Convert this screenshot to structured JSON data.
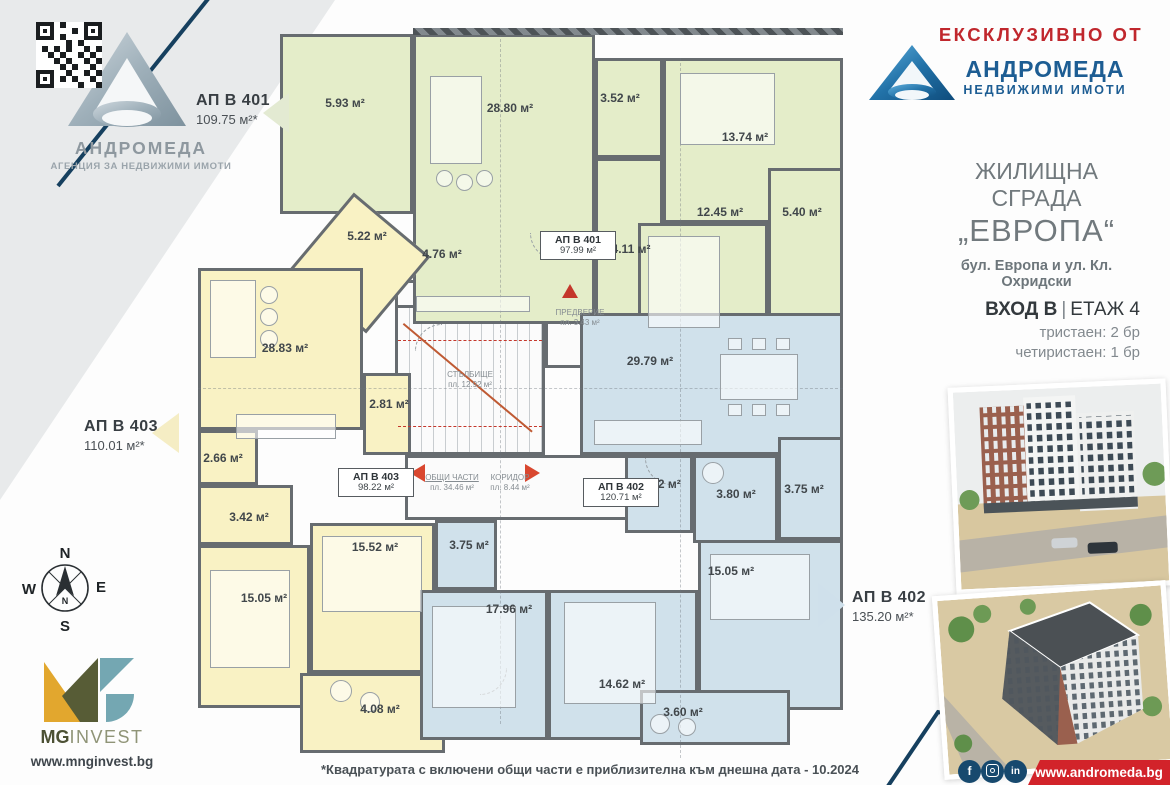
{
  "brand_left": {
    "name": "АНДРОМЕДА",
    "tagline": "АГЕНЦИЯ ЗА НЕДВИЖИМИ ИМОТИ"
  },
  "brand_right": {
    "kicker": "ЕКСКЛУЗИВНО ОТ",
    "name": "АНДРОМЕДА",
    "tagline": "НЕДВИЖИМИ ИМОТИ"
  },
  "project": {
    "type": "ЖИЛИЩНА СГРАДА",
    "name": "„ЕВРОПА“",
    "address": "бул. Европа и ул. Кл. Охридски",
    "entrance": "ВХОД В",
    "floor": "ЕТАЖ 4",
    "mix": [
      "тристаен: 2 бр",
      "четиристаен: 1 бр"
    ]
  },
  "apartments": {
    "a401": {
      "name": "АП В 401",
      "total": "109.75 м²*",
      "net": "97.99 м²"
    },
    "a402": {
      "name": "АП В 402",
      "total": "135.20 м²*",
      "net": "120.71 м²"
    },
    "a403": {
      "name": "АП В 403",
      "total": "110.01 м²*",
      "net": "98.22 м²"
    }
  },
  "rooms": {
    "g_terrace1": "5.93 м²",
    "g_living": "28.80 м²",
    "g_bath": "3.52 м²",
    "g_bed1": "13.74 м²",
    "g_bed2": "12.45 м²",
    "g_terrace2": "5.40 м²",
    "g_hall1": "4.11 м²",
    "g_hall2": "4.76 м²",
    "y_room1": "5.22 м²",
    "y_living": "28.83 м²",
    "y_hall": "2.81 м²",
    "y_wc": "2.66 м²",
    "y_bath": "3.42 м²",
    "y_bed1": "15.52 м²",
    "y_bed2": "15.05 м²",
    "y_terrace": "4.08 м²",
    "b_living": "29.79 м²",
    "b_wc": "1.92 м²",
    "b_bath": "3.80 м²",
    "b_terrace1": "3.75 м²",
    "b_store": "3.75 м²",
    "b_bed1": "17.96 м²",
    "b_bed2": "14.62 м²",
    "b_bed3": "15.05 м²",
    "b_terrace2": "3.60 м²"
  },
  "common": {
    "stairs": "СТЪЛБИЩЕ",
    "stairs_area": "пл. 12.92 м²",
    "vestibule": "ПРЕДВЕРИЕ",
    "vestibule_area": "пл. 3.43 м²",
    "shared": "ОБЩИ ЧАСТИ",
    "shared_area": "пл. 34.46 м²",
    "corridor": "КОРИДОР",
    "corridor_area": "пл. 8.44 м²"
  },
  "compass": {
    "n": "N",
    "e": "E",
    "s": "S",
    "w": "W",
    "needle": "N"
  },
  "developer": {
    "mg": "MG",
    "invest": "INVEST",
    "website": "www.mnginvest.bg"
  },
  "footer": {
    "note": "*Квадратурата с включени общи части е приблизителна към днешна дата - 10.2024",
    "website": "www.andromeda.bg"
  },
  "social": {
    "facebook": "f",
    "linkedin": "in"
  },
  "colors": {
    "apartment_green": "#e4edc9",
    "apartment_yellow": "#f9f2c4",
    "apartment_blue": "#d0e1eb",
    "accent_red": "#c0272d",
    "plan_arrow_red": "#d9472f",
    "navy": "#16405f",
    "brand_blue": "#1d5d93",
    "mg_yellow": "#e2a72e",
    "mg_olive": "#575c36",
    "mg_teal": "#74a7b2"
  }
}
